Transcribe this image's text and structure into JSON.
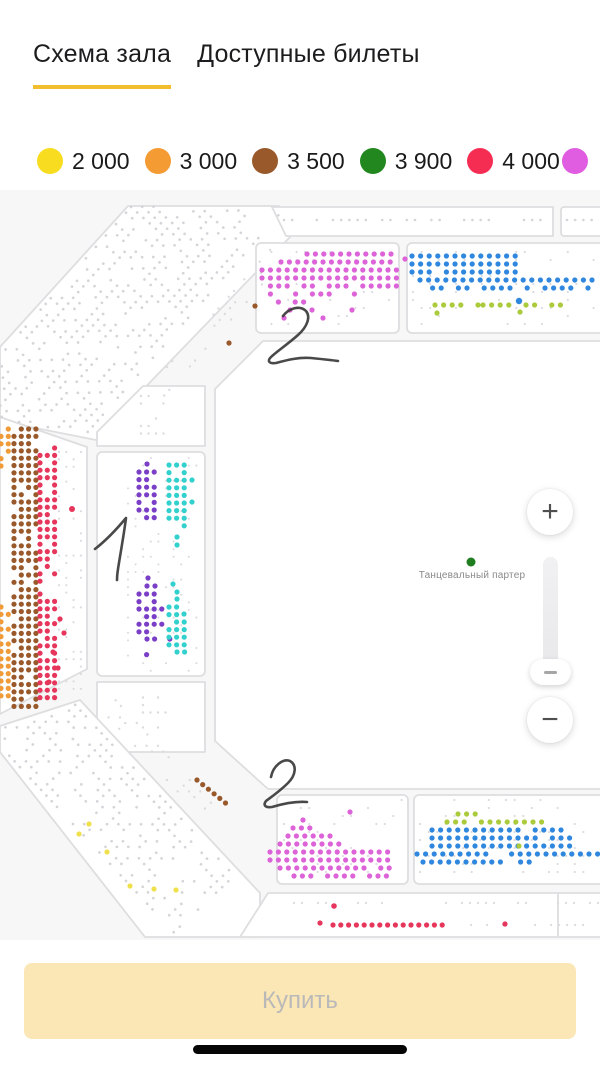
{
  "tabs": {
    "underline_color": "#F2BE2E",
    "items": [
      {
        "label": "Схема зала",
        "active": true
      },
      {
        "label": "Доступные билеты",
        "active": false
      }
    ]
  },
  "legend": {
    "items": [
      {
        "label": "2 000",
        "color": "#F8DC20"
      },
      {
        "label": "3 000",
        "color": "#F49B33"
      },
      {
        "label": "3 500",
        "color": "#99592B"
      },
      {
        "label": "3 900",
        "color": "#23871F"
      },
      {
        "label": "4 000",
        "color": "#F62D52"
      },
      {
        "label": "",
        "color": "#E05CE0"
      }
    ]
  },
  "floor": {
    "label": "Танцевальный партер",
    "dot_color": "#1F7E1F"
  },
  "zoom_control": {
    "zoom_in": "+",
    "zoom_out": "−"
  },
  "buy_button": {
    "label": "Купить",
    "bg": "#FBE7B6",
    "text_color": "#B9B9B9"
  },
  "map": {
    "bg": "#F7F7F8",
    "panel_fill": "#FFFFFF",
    "panel_stroke": "#DEDEE0",
    "palette": {
      "gray": "#D5D5D9",
      "grayL": "#DCDCE0",
      "magenta": "#DC63D8",
      "blue": "#2F87DE",
      "lime": "#ABCB3C",
      "purple": "#7A3FC6",
      "cyan": "#33D1CD",
      "brown": "#99592B",
      "orange": "#F09A38",
      "red": "#E6365C",
      "yellow": "#EFE14E",
      "green": "#1F7E1F"
    },
    "sections": [
      {
        "type": "path",
        "name": "nw-stand",
        "d": "M128,206 L279,206 L291,236 L106,428 L96,440 L0,421 L0,347 Z"
      },
      {
        "type": "path",
        "name": "top-strip-left",
        "d": "M272,207 L553,207 L553,236 L286,236 Z"
      },
      {
        "type": "rect",
        "name": "top-strip-right",
        "x": 561,
        "y": 207,
        "w": 45,
        "h": 29,
        "rx": 3
      },
      {
        "type": "rect",
        "name": "upper-left-panel",
        "x": 256,
        "y": 243,
        "w": 143,
        "h": 90,
        "rx": 5
      },
      {
        "type": "rect",
        "name": "upper-right-panel",
        "x": 407,
        "y": 243,
        "w": 199,
        "h": 90,
        "rx": 5
      },
      {
        "type": "path",
        "name": "west-stand",
        "d": "M0,417 L87,447 L87,669 L0,714 Z"
      },
      {
        "type": "path",
        "name": "inner-west-top",
        "d": "M143,386 L205,386 L205,446 L97,446 L97,432 Z"
      },
      {
        "type": "rect",
        "name": "inner-west-main",
        "x": 97,
        "y": 452,
        "w": 108,
        "h": 224,
        "rx": 5
      },
      {
        "type": "path",
        "name": "inner-west-bottom",
        "d": "M97,682 L205,682 L205,752 L123,752 L97,726 Z"
      },
      {
        "type": "path",
        "name": "floor",
        "d": "M263,341 L606,341 L606,789 L268,789 L215,741 L215,389 Z"
      },
      {
        "type": "path",
        "name": "sw-stand",
        "d": "M0,726 L80,700 L260,893 L260,937 L145,937 L0,752 Z"
      },
      {
        "type": "path",
        "name": "bottom-strip",
        "d": "M268,893 L606,893 L606,937 L240,937 Z"
      },
      {
        "type": "rect",
        "name": "bottom-left-panel",
        "x": 277,
        "y": 795,
        "w": 131,
        "h": 89,
        "rx": 5
      },
      {
        "type": "rect",
        "name": "bottom-right-panel",
        "x": 414,
        "y": 795,
        "w": 192,
        "h": 89,
        "rx": 5
      }
    ],
    "lines": [
      {
        "x1": 558,
        "y1": 893,
        "x2": 558,
        "y2": 937
      }
    ],
    "clusters": [
      {
        "c": "gray",
        "x": 284,
        "y": 220,
        "cols": 5,
        "dx": 8.2,
        "r": 1.3,
        "d": 0.75
      },
      {
        "c": "gray",
        "x": 333,
        "y": 220,
        "cols": 20,
        "dx": 8.2,
        "r": 1.3,
        "d": 0.85
      },
      {
        "c": "gray",
        "x": 524,
        "y": 220,
        "cols": 3,
        "dx": 8.2,
        "r": 1.3,
        "d": 0.9
      },
      {
        "c": "gray",
        "x": 567,
        "y": 220,
        "cols": 4,
        "dx": 8.2,
        "r": 1.3,
        "d": 0.9
      },
      {
        "c": "gray",
        "x": 131,
        "y": 207,
        "cols": 50,
        "i0": -13,
        "rows": 15,
        "dx": 7.6,
        "dy": 8.3,
        "r": 1.35,
        "d": 0.58,
        "ux": -0.66,
        "uy": 0.75,
        "vx": 0.75,
        "vy": 0.66,
        "clip": [
          [
            128,
            205
          ],
          [
            279,
            205
          ],
          [
            290,
            233
          ],
          [
            106,
            428
          ],
          [
            96,
            440
          ],
          [
            0,
            422
          ],
          [
            0,
            347
          ]
        ]
      },
      {
        "c": "grayL",
        "x": 270,
        "y": 250,
        "cols": 24,
        "rows": 3,
        "dx": 7.8,
        "dy": 8.4,
        "r": 1.2,
        "d": 0.3,
        "ux": -0.66,
        "uy": 0.75,
        "vx": 0.75,
        "vy": 0.66
      },
      {
        "c": "grayL",
        "x": 141,
        "y": 396,
        "cols": 4,
        "rows": 6,
        "r": 1.2,
        "d": 0.6
      },
      {
        "c": "grayL",
        "x": 59,
        "y": 452,
        "cols": 4,
        "rows": 33,
        "dx": 7.3,
        "dy": 7.4,
        "r": 1.1,
        "d": 0.3
      },
      {
        "c": "orange",
        "x": 1,
        "y": 429,
        "cols": 2,
        "rows": 6,
        "dx": 7.3,
        "dy": 7.4,
        "d": 0.75
      },
      {
        "c": "orange",
        "x": 1,
        "y": 607,
        "cols": 2,
        "rows": 13,
        "dx": 7.3,
        "dy": 7.4,
        "d": 0.85
      },
      {
        "c": "brown",
        "x": 14,
        "y": 429,
        "cols": 4,
        "rows": 39,
        "dx": 7.3,
        "dy": 7.3,
        "d": 0.9
      },
      {
        "c": "red",
        "x": 40,
        "y": 448,
        "cols": 3,
        "rows": 19,
        "dx": 7.3,
        "dy": 7.4,
        "d": 0.7
      },
      {
        "c": "red",
        "x": 40,
        "y": 594,
        "cols": 3,
        "rows": 15,
        "dx": 7.3,
        "dy": 7.4,
        "d": 0.82
      },
      {
        "c": "grayL",
        "x": 128,
        "y": 458,
        "cols": 10,
        "rows": 29,
        "dx": 7.6,
        "dy": 7.6,
        "r": 1.05,
        "d": 0.25
      },
      {
        "c": "purple",
        "x": 139,
        "y": 472,
        "cols": 3,
        "rows": 7,
        "dx": 7.6,
        "dy": 7.6,
        "d": 0.85
      },
      {
        "c": "cyan",
        "x": 169,
        "y": 465,
        "cols": 3,
        "rows": 9,
        "dx": 7.6,
        "dy": 7.6,
        "d": 0.8
      },
      {
        "c": "purple",
        "x": 139,
        "y": 594,
        "cols": 3,
        "rows": 2,
        "dx": 7.6,
        "dy": 7.6,
        "d": 0.8
      },
      {
        "c": "purple",
        "x": 139,
        "y": 609,
        "cols": 4,
        "rows": 4,
        "dx": 7.6,
        "dy": 7.6,
        "d": 0.92
      },
      {
        "c": "purple",
        "x": 147,
        "y": 639,
        "cols": 4,
        "dx": 7.6,
        "d": 0.8
      },
      {
        "c": "purple",
        "x": 139,
        "y": 647,
        "cols": 3,
        "rows": 2,
        "dx": 7.6,
        "dy": 7.6,
        "d": 0.45
      },
      {
        "c": "cyan",
        "x": 169,
        "y": 607,
        "cols": 2,
        "rows": 2,
        "dx": 7.6,
        "dy": 7.6,
        "d": 0.8
      },
      {
        "c": "cyan",
        "x": 169,
        "y": 622,
        "cols": 3,
        "rows": 4,
        "dx": 7.6,
        "dy": 7.6,
        "d": 0.88
      },
      {
        "c": "cyan",
        "x": 177,
        "y": 652,
        "cols": 2,
        "dx": 7.6,
        "d": 0.95
      },
      {
        "c": "grayL",
        "x": 143,
        "y": 690,
        "cols": 4,
        "rows": 6,
        "r": 1.2,
        "d": 0.55
      },
      {
        "c": "grayL",
        "x": 263,
        "y": 252,
        "cols": 16,
        "rows": 10,
        "dx": 8.4,
        "dy": 8,
        "r": 1.1,
        "d": 0.2
      },
      {
        "c": "magenta",
        "x": 307,
        "y": 254,
        "cols": 11,
        "dx": 8.4,
        "d": 0.95
      },
      {
        "c": "magenta",
        "x": 281,
        "y": 262,
        "cols": 14,
        "dx": 8.4,
        "d": 0.95
      },
      {
        "c": "magenta",
        "x": 262,
        "y": 270,
        "cols": 17,
        "rows": 2,
        "dx": 8.4,
        "dy": 8,
        "d": 0.96
      },
      {
        "c": "magenta",
        "x": 262,
        "y": 286,
        "cols": 17,
        "dx": 8.4,
        "d": 0.8
      },
      {
        "c": "magenta",
        "x": 262,
        "y": 294,
        "cols": 14,
        "dx": 8.4,
        "d": 0.55
      },
      {
        "c": "magenta",
        "x": 270,
        "y": 302,
        "cols": 10,
        "dx": 8.4,
        "d": 0.4
      },
      {
        "c": "grayL",
        "x": 413,
        "y": 252,
        "cols": 22,
        "rows": 10,
        "dx": 8.6,
        "dy": 8,
        "r": 1.1,
        "d": 0.2
      },
      {
        "c": "blue",
        "x": 412,
        "y": 256,
        "cols": 13,
        "rows": 3,
        "dx": 8.6,
        "dy": 8,
        "d": 0.96
      },
      {
        "c": "blue",
        "x": 420,
        "y": 280,
        "cols": 21,
        "dx": 8.6,
        "d": 0.97
      },
      {
        "c": "blue",
        "x": 424,
        "y": 288,
        "cols": 14,
        "dx": 8.6,
        "d": 0.9
      },
      {
        "c": "blue",
        "x": 545,
        "y": 288,
        "cols": 7,
        "dx": 8.6,
        "d": 0.55
      },
      {
        "c": "lime",
        "x": 435,
        "y": 305,
        "cols": 6,
        "dx": 8.6,
        "d": 0.45
      },
      {
        "c": "lime",
        "x": 483,
        "y": 305,
        "cols": 10,
        "dx": 8.6,
        "d": 0.85
      },
      {
        "c": "gray",
        "x": 4,
        "y": 750,
        "cols": 36,
        "i0": -3,
        "rows": 15,
        "dx": 7.8,
        "dy": 8.3,
        "r": 1.35,
        "d": 0.55,
        "ux": 0.68,
        "uy": 0.73,
        "vx": 0.73,
        "vy": -0.68,
        "clip": [
          [
            0,
            726
          ],
          [
            80,
            700
          ],
          [
            260,
            893
          ],
          [
            260,
            937
          ],
          [
            145,
            937
          ],
          [
            0,
            752
          ]
        ]
      },
      {
        "c": "grayL",
        "x": 98,
        "y": 706,
        "cols": 20,
        "rows": 3,
        "dx": 7.8,
        "dy": 8.4,
        "r": 1.2,
        "d": 0.3,
        "ux": 0.68,
        "uy": 0.73,
        "vx": 0.73,
        "vy": -0.68
      },
      {
        "c": "brown",
        "x": 197,
        "y": 780,
        "cols": 6,
        "dx": 7.3,
        "ux": 0.78,
        "uy": 0.63
      },
      {
        "c": "grayL",
        "x": 284,
        "y": 800,
        "cols": 15,
        "rows": 10,
        "dx": 8.4,
        "dy": 8,
        "r": 1.1,
        "d": 0.22
      },
      {
        "c": "magenta",
        "x": 293,
        "y": 828,
        "cols": 3,
        "dx": 8.4,
        "d": 0.9
      },
      {
        "c": "magenta",
        "x": 288,
        "y": 836,
        "cols": 6,
        "dx": 8.4,
        "d": 0.9
      },
      {
        "c": "magenta",
        "x": 280,
        "y": 844,
        "cols": 8,
        "dx": 8.4,
        "d": 0.92
      },
      {
        "c": "magenta",
        "x": 270,
        "y": 852,
        "cols": 15,
        "rows": 2,
        "dx": 8.4,
        "dy": 8,
        "d": 0.95
      },
      {
        "c": "magenta",
        "x": 280,
        "y": 868,
        "cols": 14,
        "dx": 8.4,
        "d": 0.92
      },
      {
        "c": "magenta",
        "x": 294,
        "y": 876,
        "cols": 12,
        "dx": 8.4,
        "d": 0.9
      },
      {
        "c": "grayL",
        "x": 420,
        "y": 800,
        "cols": 21,
        "rows": 10,
        "dx": 8.6,
        "dy": 8,
        "r": 1.1,
        "d": 0.22
      },
      {
        "c": "lime",
        "x": 458,
        "y": 814,
        "cols": 3,
        "dx": 8.6
      },
      {
        "c": "lime",
        "x": 447,
        "y": 822,
        "cols": 12,
        "dx": 8.6,
        "d": 0.85
      },
      {
        "c": "blue",
        "x": 432,
        "y": 830,
        "cols": 17,
        "rows": 3,
        "dx": 8.6,
        "dy": 8,
        "d": 0.96
      },
      {
        "c": "blue",
        "x": 417,
        "y": 854,
        "cols": 22,
        "dx": 8.6,
        "d": 0.97
      },
      {
        "c": "blue",
        "x": 423,
        "y": 862,
        "cols": 10,
        "dx": 8.6,
        "d": 0.9
      },
      {
        "c": "blue",
        "x": 512,
        "y": 862,
        "cols": 3,
        "dx": 8.6,
        "d": 0.6
      },
      {
        "c": "grayL",
        "x": 286,
        "y": 903,
        "cols": 40,
        "dx": 8,
        "r": 1.15,
        "d": 0.4
      },
      {
        "c": "grayL",
        "x": 455,
        "y": 925,
        "cols": 18,
        "dx": 8,
        "r": 1.15,
        "d": 0.45
      },
      {
        "c": "red",
        "x": 333,
        "y": 925,
        "cols": 15,
        "dx": 7.8,
        "d": 0.95
      }
    ],
    "singles": [
      {
        "c": "magenta",
        "x": 405,
        "y": 259
      },
      {
        "c": "magenta",
        "x": 290,
        "y": 310
      },
      {
        "c": "magenta",
        "x": 312,
        "y": 310
      },
      {
        "c": "magenta",
        "x": 352,
        "y": 310
      },
      {
        "c": "magenta",
        "x": 284,
        "y": 318
      },
      {
        "c": "magenta",
        "x": 323,
        "y": 318
      },
      {
        "c": "blue",
        "x": 519,
        "y": 301,
        "r": 3.2
      },
      {
        "c": "lime",
        "x": 437,
        "y": 313
      },
      {
        "c": "lime",
        "x": 520,
        "y": 312
      },
      {
        "c": "lime",
        "x": 519,
        "y": 846
      },
      {
        "c": "brown",
        "x": 255,
        "y": 306
      },
      {
        "c": "brown",
        "x": 229,
        "y": 343
      },
      {
        "c": "red",
        "x": 72,
        "y": 509,
        "r": 3
      },
      {
        "c": "red",
        "x": 60,
        "y": 619
      },
      {
        "c": "red",
        "x": 64,
        "y": 633
      },
      {
        "c": "red",
        "x": 53,
        "y": 652
      },
      {
        "c": "red",
        "x": 58,
        "y": 668
      },
      {
        "c": "red",
        "x": 49,
        "y": 682
      },
      {
        "c": "purple",
        "x": 147,
        "y": 464
      },
      {
        "c": "purple",
        "x": 148,
        "y": 578
      },
      {
        "c": "purple",
        "x": 147,
        "y": 586
      },
      {
        "c": "purple",
        "x": 155,
        "y": 586
      },
      {
        "c": "cyan",
        "x": 192,
        "y": 480
      },
      {
        "c": "cyan",
        "x": 192,
        "y": 502
      },
      {
        "c": "cyan",
        "x": 177,
        "y": 537
      },
      {
        "c": "cyan",
        "x": 177,
        "y": 545
      },
      {
        "c": "cyan",
        "x": 173,
        "y": 584
      },
      {
        "c": "cyan",
        "x": 177,
        "y": 592
      },
      {
        "c": "cyan",
        "x": 177,
        "y": 599
      },
      {
        "c": "cyan",
        "x": 184,
        "y": 614
      },
      {
        "c": "yellow",
        "x": 89,
        "y": 824
      },
      {
        "c": "yellow",
        "x": 79,
        "y": 834
      },
      {
        "c": "yellow",
        "x": 107,
        "y": 852
      },
      {
        "c": "yellow",
        "x": 130,
        "y": 886
      },
      {
        "c": "yellow",
        "x": 154,
        "y": 889
      },
      {
        "c": "yellow",
        "x": 176,
        "y": 890
      },
      {
        "c": "magenta",
        "x": 350,
        "y": 812
      },
      {
        "c": "magenta",
        "x": 303,
        "y": 820
      },
      {
        "c": "red",
        "x": 334,
        "y": 906,
        "r": 2.8
      },
      {
        "c": "red",
        "x": 320,
        "y": 923
      },
      {
        "c": "red",
        "x": 505,
        "y": 924
      },
      {
        "c": "green",
        "x": 471,
        "y": 562,
        "r": 4.5
      }
    ],
    "ink": {
      "color": "#3A3A3A",
      "width": 2.6,
      "paths": [
        "M283,316 C289,308 300,305 306,311 C311,317 307,327 298,335 C288,344 276,352 271,357 C267,361 269,364 276,363 C287,360 299,357 311,358 C321,359 331,360 338,361",
        "M95,549 C104,542 116,530 126,518 C124,534 120,556 118,569 C117,575 117,578 117,580",
        "M271,777 C273,766 283,758 290,761 C297,765 296,775 288,783 C280,791 270,798 266,801 C263,805 265,808 272,807 C282,804 295,801 307,802"
      ]
    }
  }
}
